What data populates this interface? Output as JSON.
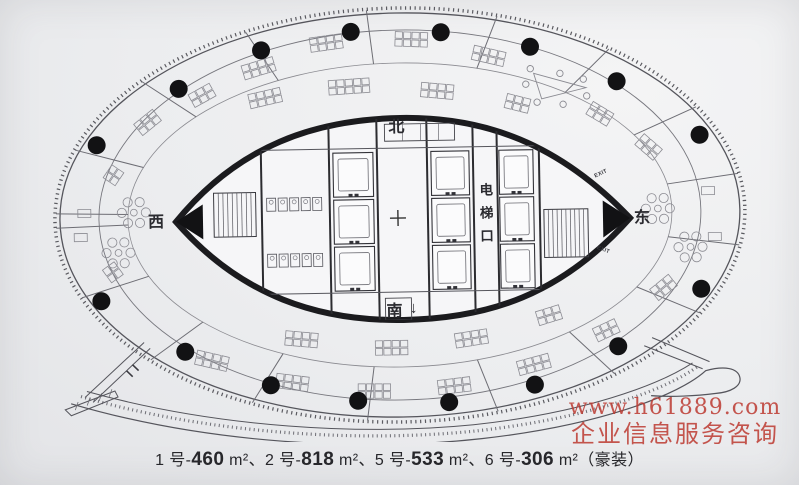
{
  "palette": {
    "paper": "#ecedef",
    "ink": "#3c3c42",
    "wall": "#161618",
    "furniture": "#8b8b92",
    "watermark_red": "#bd3a31"
  },
  "compass": {
    "north": "北",
    "south": "南",
    "east": "东",
    "west": "西",
    "south_arrow": "↓"
  },
  "core": {
    "elevator_label": "电梯口",
    "exit_label": "EXIT"
  },
  "watermark": {
    "url": "www.h61889.com",
    "caption": "企业信息服务咨询"
  },
  "caption": {
    "runs": [
      {
        "text": "1 号-",
        "bold": false
      },
      {
        "text": "460",
        "bold": true
      },
      {
        "text": " m²、2 号-",
        "bold": false
      },
      {
        "text": "818",
        "bold": true
      },
      {
        "text": " m²、5 号-",
        "bold": false
      },
      {
        "text": "533",
        "bold": true
      },
      {
        "text": " m²、6 号-",
        "bold": false
      },
      {
        "text": "306",
        "bold": true
      },
      {
        "text": " m²（豪装）",
        "bold": false
      }
    ]
  }
}
